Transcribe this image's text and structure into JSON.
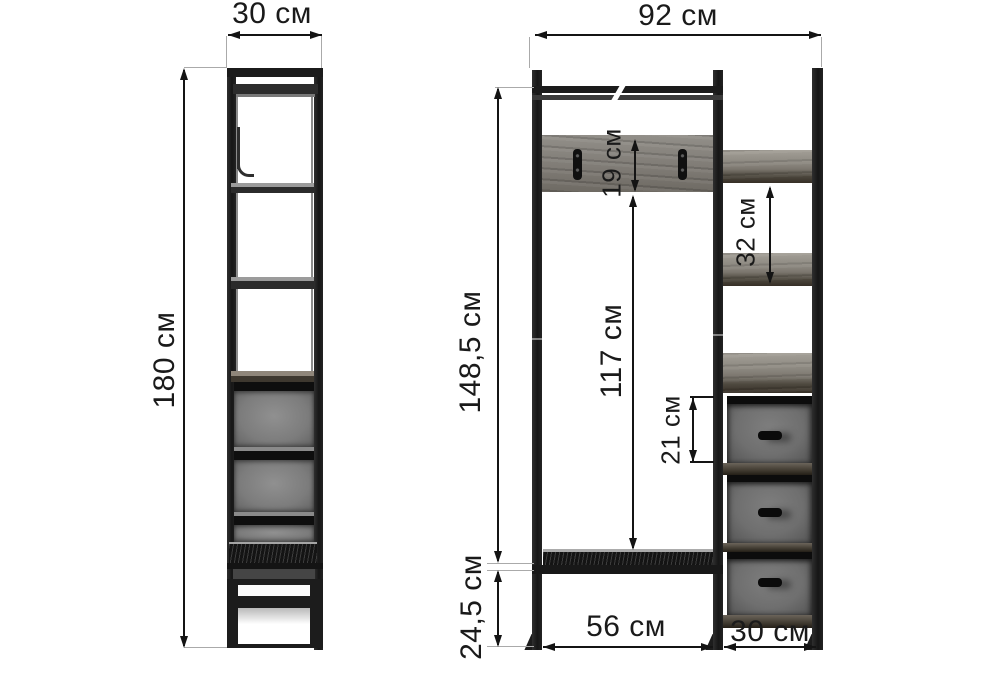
{
  "unit": "см",
  "colors": {
    "background": "#ffffff",
    "dimension_line": "#141414",
    "extension_line": "#aaaaaa",
    "frame": "#1b1b1b",
    "wood": "#87827a",
    "fabric": "#6f6f6f"
  },
  "side_view": {
    "width_label": "30 см",
    "height_label": "180 см"
  },
  "front_view": {
    "width_label": "92 см",
    "height_label": "148,5 см",
    "base_height_label": "24,5 см",
    "hook_panel_height_label": "19 см",
    "inner_height_label": "117 см",
    "shelf_gap_label": "32 см",
    "drawer_height_label": "21 см",
    "opening_width_label": "56 см",
    "column_width_label": "30 см"
  }
}
